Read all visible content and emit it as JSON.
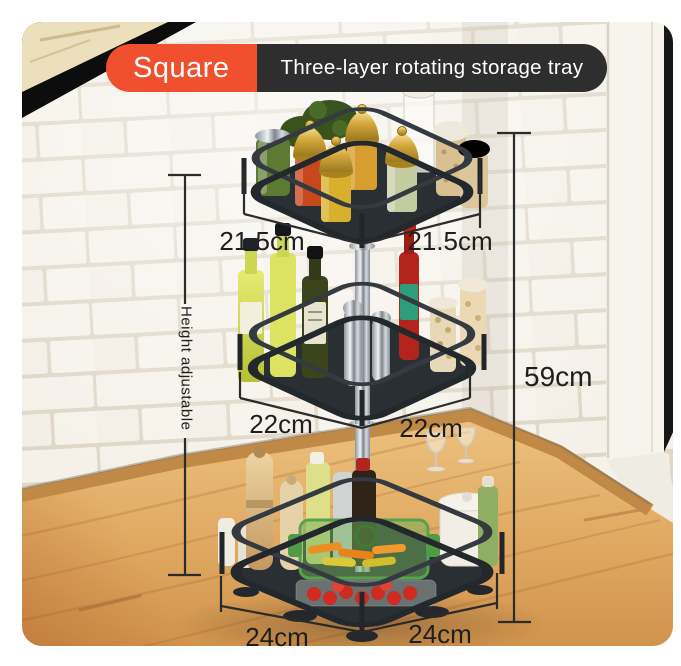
{
  "banner": {
    "badge_label": "Square",
    "title": "Three-layer rotating storage tray",
    "badge_color": "#f0502e",
    "bar_color": "#2e2e2e",
    "text_color": "#ffffff"
  },
  "annotations": {
    "text_color": "#1e1e1e",
    "tier1_left": "21.5cm",
    "tier1_right": "21.5cm",
    "tier2_left": "22cm",
    "tier2_right": "22cm",
    "base_left": "24cm",
    "base_right": "24cm",
    "total_height": "59cm",
    "height_note": "Height adjustable"
  },
  "product": {
    "type": "rotating storage rack",
    "shape": "square",
    "tier_count": 3
  },
  "colors": {
    "accent": "#f0502e",
    "banner_dark": "#2e2e2e",
    "rack_metal": "#2b3036",
    "tile_wall": "#f3efe8",
    "wood_floor": "#dfa963",
    "dimension_lines": "#2b2b2b"
  }
}
